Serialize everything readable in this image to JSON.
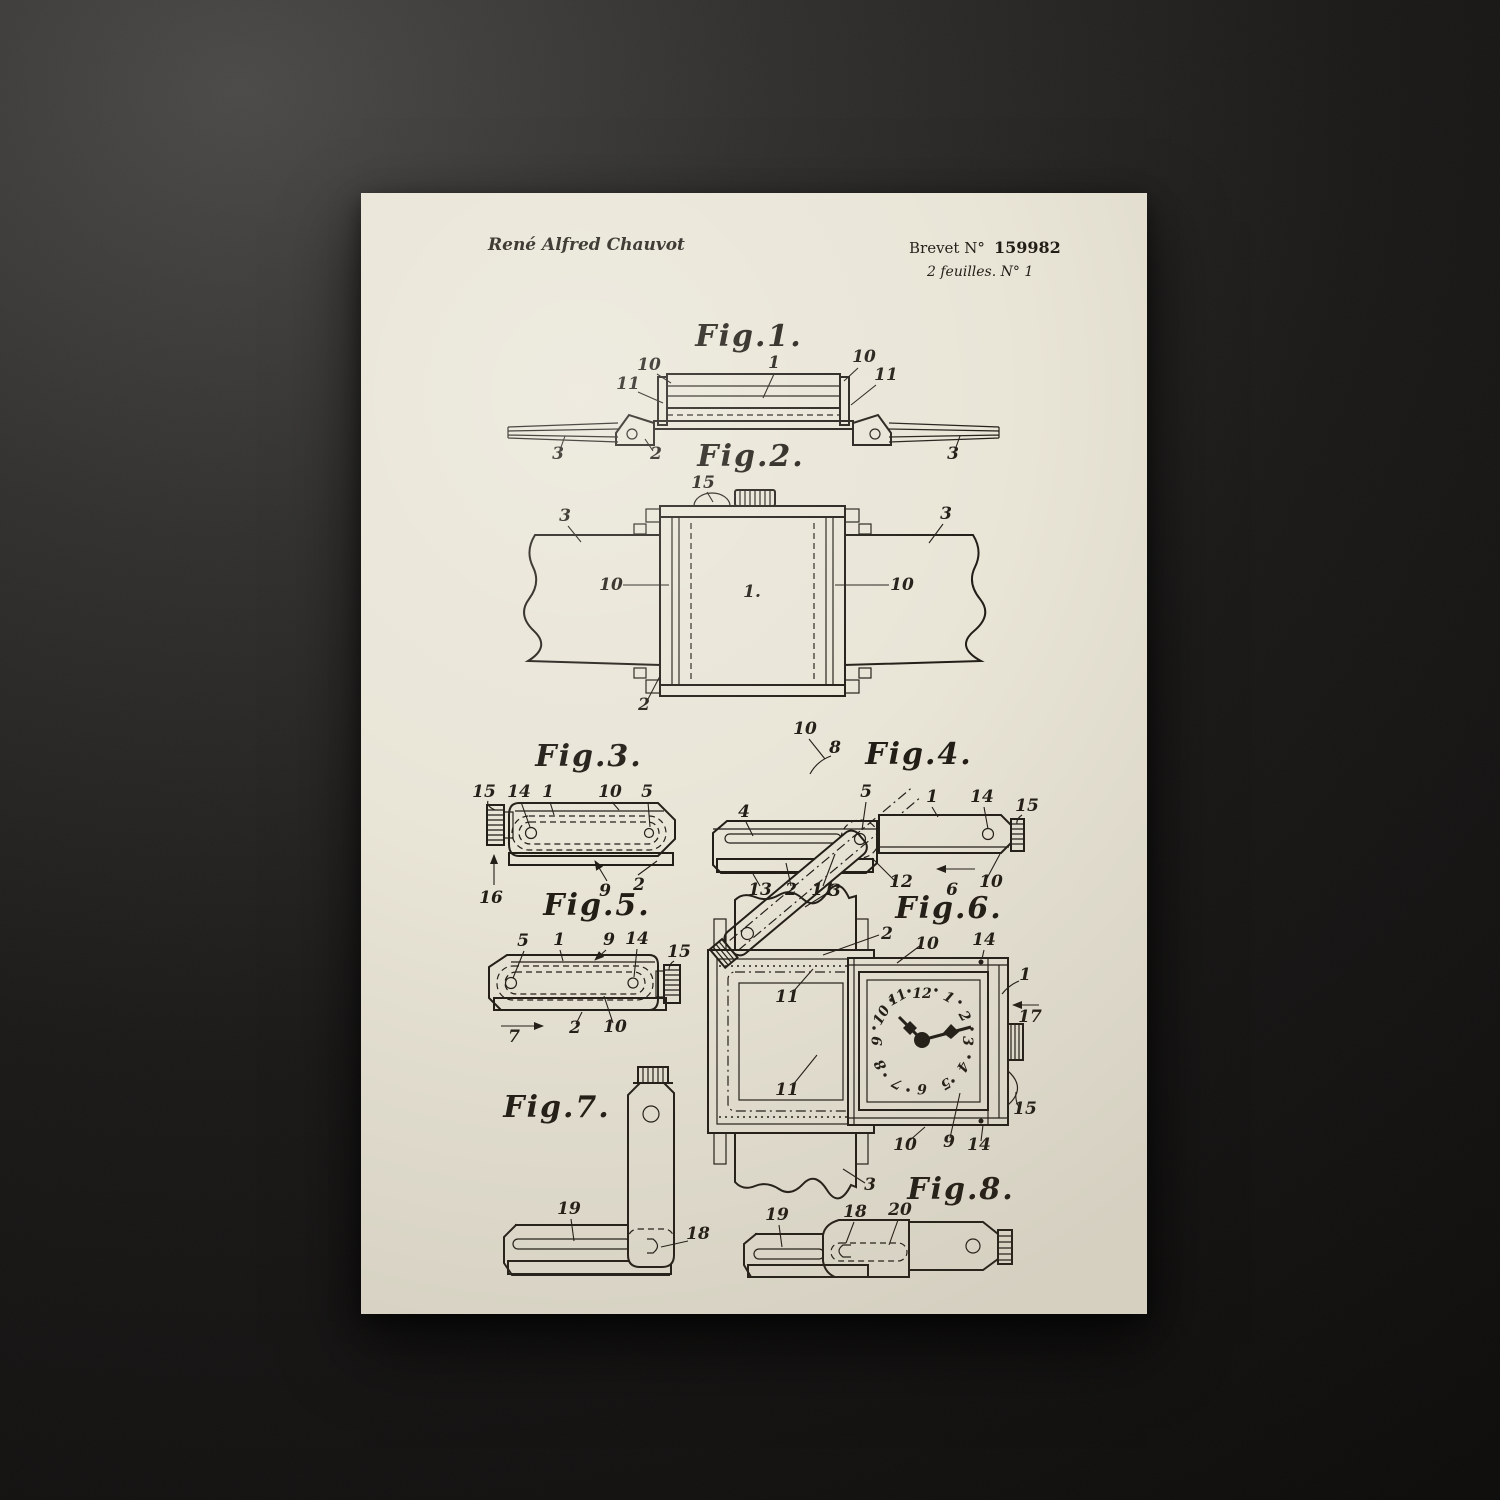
{
  "colors": {
    "desk": "#141312",
    "paper": "#e9e5d7",
    "ink": "#221e18"
  },
  "header": {
    "author": "René Alfred Chauvot",
    "brevet_label": "Brevet  N°",
    "brevet_number": "159982",
    "sheet_info": "2 feuilles.   N° 1"
  },
  "figures": {
    "fig1": {
      "title": "Fig.1.",
      "labels": [
        "10",
        "1",
        "10",
        "11",
        "11",
        "3",
        "2",
        "3"
      ]
    },
    "fig2": {
      "title": "Fig.2.",
      "labels": [
        "15",
        "3",
        "3",
        "10",
        "1.",
        "10",
        "2"
      ]
    },
    "fig3": {
      "title": "Fig.3.",
      "labels": [
        "15",
        "14",
        "1",
        "10",
        "5",
        "16",
        "9",
        "2"
      ]
    },
    "fig4": {
      "title": "Fig.4.",
      "labels": [
        "10",
        "8",
        "4",
        "5",
        "1",
        "14",
        "15",
        "13",
        "2",
        "11",
        "12",
        "6",
        "10"
      ]
    },
    "fig5": {
      "title": "Fig.5.",
      "labels": [
        "5",
        "1",
        "9",
        "14",
        "15",
        "7",
        "2",
        "10"
      ]
    },
    "fig6": {
      "title": "Fig.6.",
      "labels": [
        "3",
        "2",
        "10",
        "14",
        "1",
        "17",
        "11",
        "11",
        "15",
        "10",
        "9",
        "14",
        "3"
      ],
      "dial_numerals": [
        "12",
        "1",
        "2",
        "3",
        "4",
        "5",
        "6",
        "7",
        "8",
        "9",
        "10",
        "11"
      ]
    },
    "fig7": {
      "title": "Fig.7.",
      "labels": [
        "19",
        "18"
      ]
    },
    "fig8": {
      "title": "Fig.8.",
      "labels": [
        "19",
        "18",
        "20"
      ]
    }
  }
}
